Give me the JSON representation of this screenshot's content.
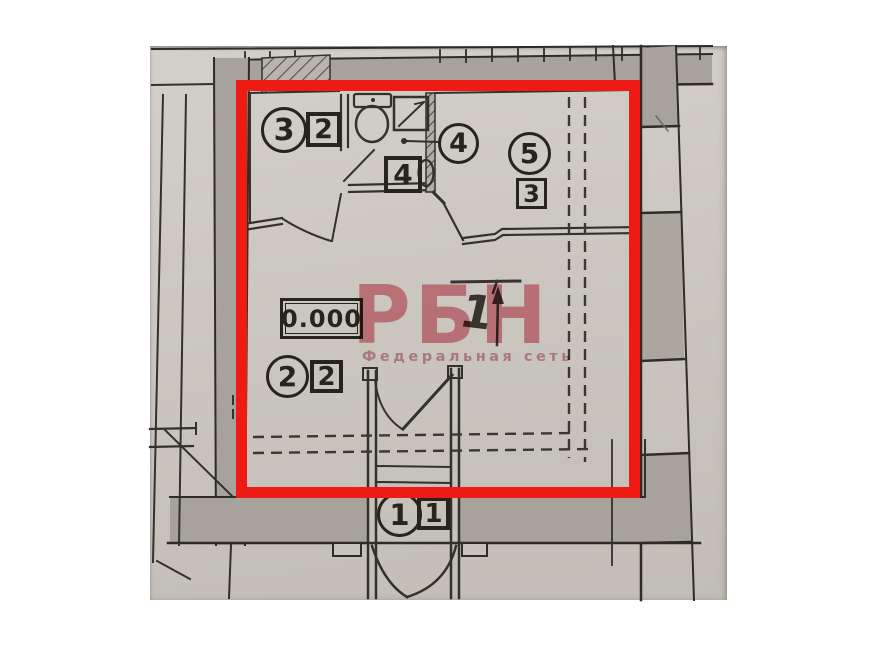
{
  "photo": {
    "paper_color": "#cbc7c0"
  },
  "highlight_box": {
    "color": "#ee1b15"
  },
  "watermark": {
    "brand": "РБН",
    "tagline": "Федеральная сеть",
    "color": "#df7080"
  },
  "plan": {
    "elevation_mark": "0.000",
    "direction_mark": "1",
    "labels": [
      {
        "circle": "3",
        "square": "2"
      },
      {
        "circle": "4",
        "square": "4"
      },
      {
        "circle": "5",
        "square": "3"
      },
      {
        "circle": "2",
        "square": "2"
      },
      {
        "circle": "1",
        "square": "1"
      }
    ]
  }
}
